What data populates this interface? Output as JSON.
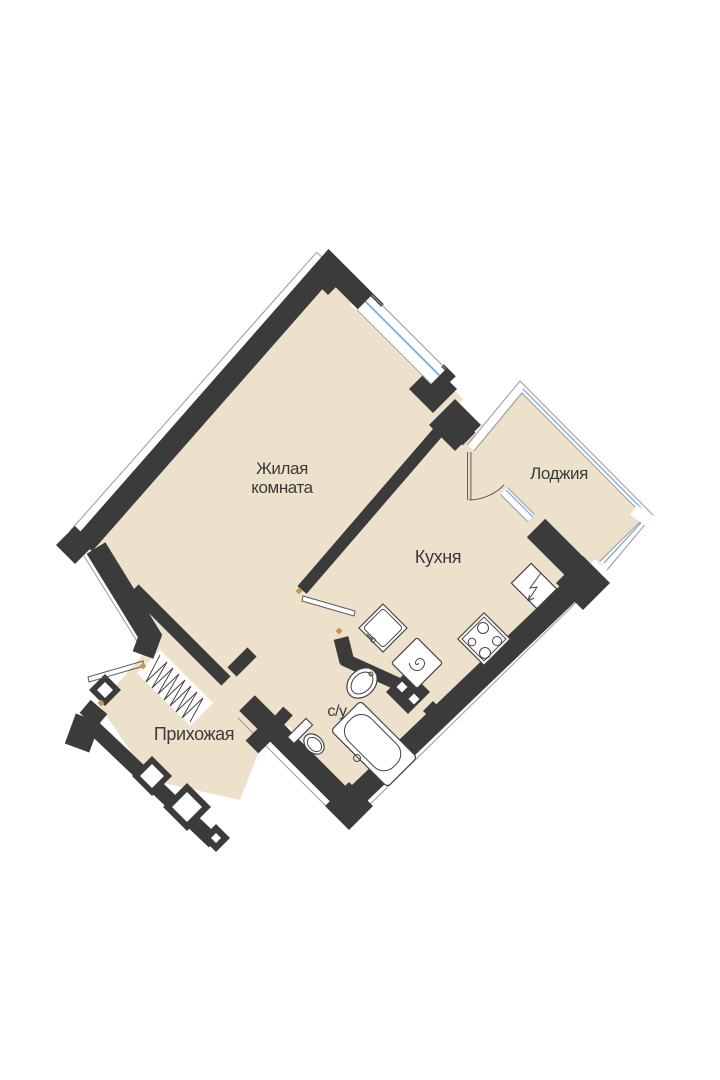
{
  "floor_plan": {
    "type": "apartment-floor-plan",
    "orientation": "rotated-45deg",
    "rooms": {
      "living": {
        "line1": "Жилая",
        "line2": "комната"
      },
      "kitchen": {
        "label": "Кухня"
      },
      "loggia": {
        "label": "Лоджия"
      },
      "hallway": {
        "label": "Прихожая"
      },
      "bathroom": {
        "label": "с/у"
      }
    },
    "fixtures": [
      "bathtub",
      "toilet",
      "washbasin",
      "kitchen-sink",
      "washing-machine",
      "stove-4-burners",
      "electrical-panel-lightning"
    ],
    "openings": [
      "entrance-door-open-leaf",
      "kitchen-door-open-leaf",
      "balcony-door-with-arc",
      "living-room-window",
      "balcony-window",
      "loggia-glazing"
    ]
  },
  "colors": {
    "background": "#ffffff",
    "floor": "#eee1cb",
    "wall": "#3b3b3c",
    "glass": "#85b4dc",
    "accent": "#c9974f",
    "label": "#3a3a3a",
    "fixture": "#454545",
    "outline": "#9a9a9a"
  }
}
